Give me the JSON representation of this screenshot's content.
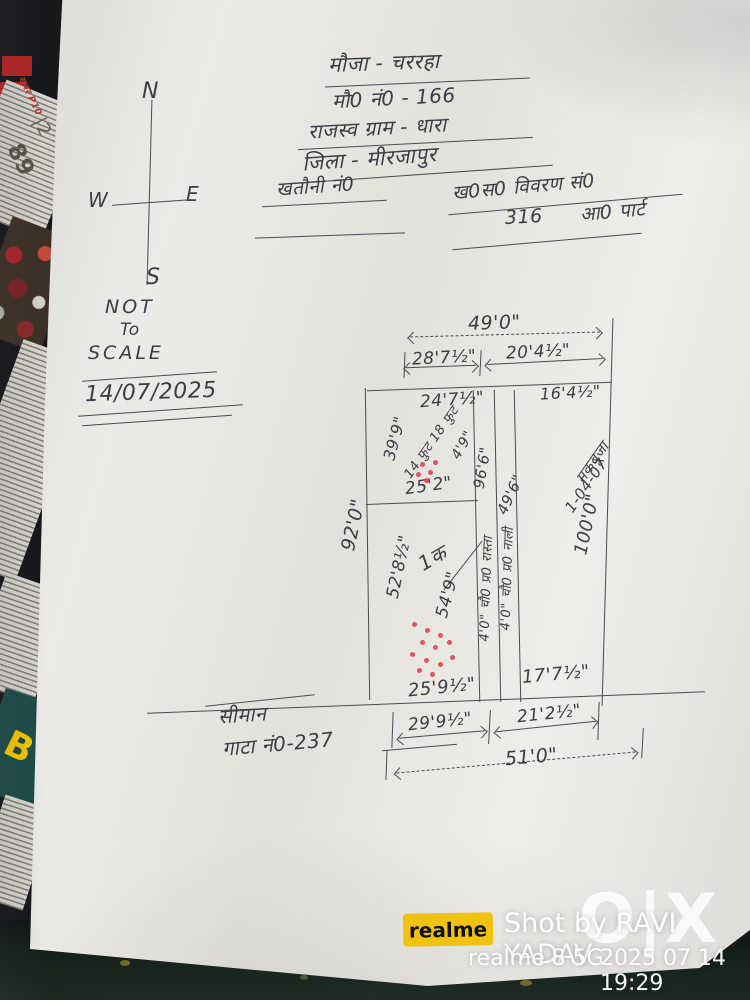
{
  "header": {
    "line1": "मौजा - चररहा",
    "line2": "मौ0 नं0 - 166",
    "line3": "राजस्व ग्राम - धारा",
    "line4": "जिला - मीरजापुर",
    "khatauni_label": "खतौनी नं0",
    "khasra_label": "ख0स0 विवरण सं0",
    "khasra_number": "316",
    "khasra_part": "आ0 पार्ट"
  },
  "compass": {
    "n": "N",
    "e": "E",
    "w": "W",
    "s": "S"
  },
  "note": {
    "l1": "NOT",
    "l2": "To",
    "l3": "SCALE",
    "date": "14/07/2025"
  },
  "diagram": {
    "top_total": "49'0\"",
    "top_left_seg": "28'7½\"",
    "top_right_seg": "20'4½\"",
    "inner_top_left": "24'7½\"",
    "inner_top_right": "16'4½\"",
    "left_outer": "92'0\"",
    "small_plot": {
      "left": "39'9\"",
      "note": "14 फुट 18 फुट",
      "side": "4'9\"",
      "bottom": "25'2\""
    },
    "strips": {
      "len_a": "96'6\"",
      "len_b": "49'6\"",
      "label_a": "4'0\" चौ0 प्र0 रास्ता",
      "label_b": "4'0\" चौ0 प्र0 नाली"
    },
    "plot1": {
      "number": "1क",
      "inner_left": "52'8½\"",
      "right": "54'9\"",
      "bottom": "25'9½\""
    },
    "right_plot": {
      "bottom": "17'7½\"",
      "right": "100'0\"",
      "note1": "मकबूजा",
      "note2": "1-04-07"
    },
    "bottom_left_seg": "29'9½\"",
    "bottom_right_seg": "21'2½\"",
    "bottom_total": "51'0\"",
    "boundary": {
      "line1": "सीमान",
      "line2": "गाटा नं0-237"
    }
  },
  "newspaper": {
    "page_number": "89",
    "side_number": "|2",
    "red_label": "खबर P10",
    "big_letter": "B"
  },
  "watermark": {
    "brand": "realme",
    "shot_by": "Shot by RAVI YADAV",
    "device": "realme 8 5G",
    "datetime": "2025 07 14 19:29",
    "olx": "O|X"
  }
}
